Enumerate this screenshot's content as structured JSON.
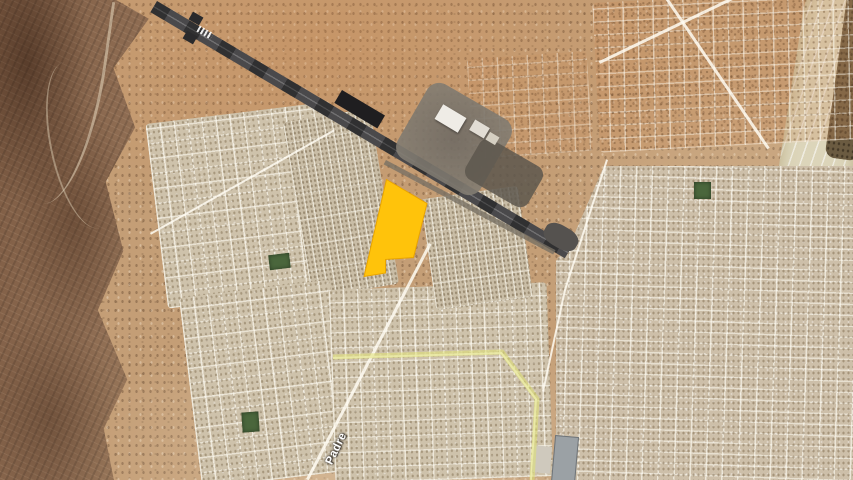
{
  "map": {
    "view": "satellite",
    "street_label": "Padre",
    "colors": {
      "parcel_fill": "#FFC30B",
      "parcel_stroke": "#E9A400",
      "route": "#DEE071",
      "runway": "#4A494B",
      "desert": "#C49E76",
      "urban": "#CEC2AB",
      "wash": "#DCD5BA",
      "park": "#4A663C"
    },
    "parcel_points": "386.5,179.5 427,203.5 413.5,257.5 385.5,259.5 385.5,273 364,276.5",
    "route_points": "333,357 502,352 537,399 532,480"
  }
}
